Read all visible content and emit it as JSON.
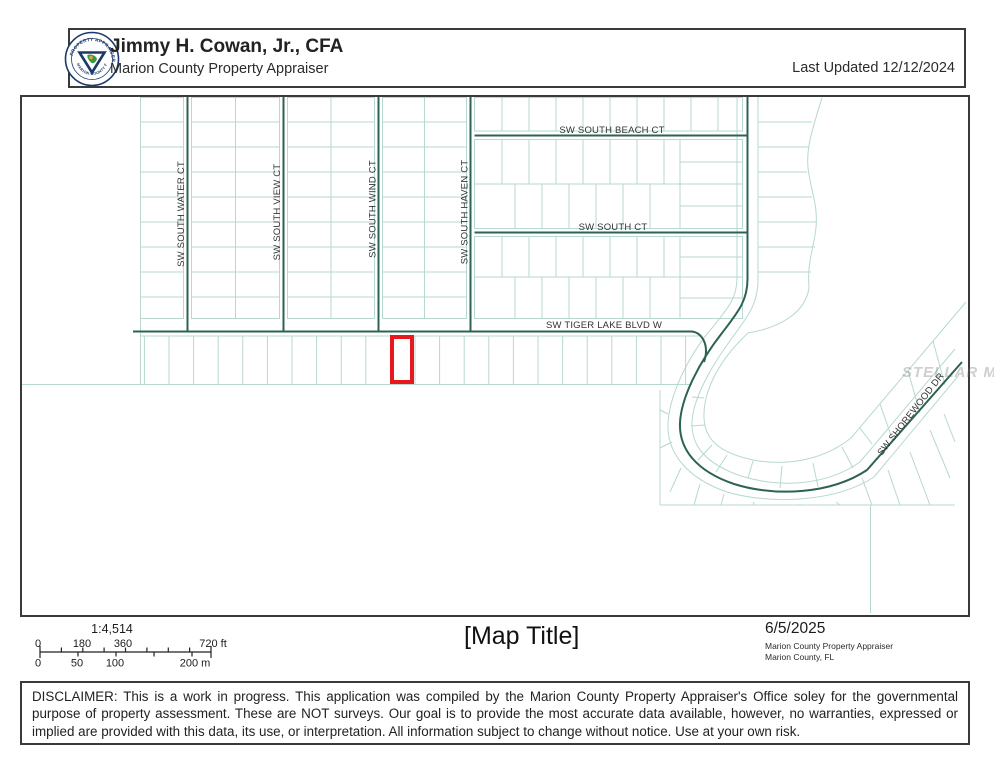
{
  "header": {
    "title": "Jimmy H. Cowan, Jr., CFA",
    "subtitle": "Marion County Property Appraiser",
    "last_updated": "Last Updated 12/12/2024",
    "logo": {
      "ring_top": "PROPERTY APPRAISER",
      "ring_bottom": "MARION COUNTY FLORIDA"
    }
  },
  "map": {
    "streets": {
      "water": "SW SOUTH WATER CT",
      "view": "SW SOUTH VIEW CT",
      "wind": "SW SOUTH WIND CT",
      "haven": "SW SOUTH HAVEN CT",
      "beach": "SW SOUTH BEACH CT",
      "south": "SW SOUTH CT",
      "tiger": "SW TIGER LAKE BLVD W",
      "shorewood": "SW SHOREWOOD DR"
    },
    "watermark": "STELLAR MLS",
    "colors": {
      "selected_parcel": "#e8191c",
      "street_line": "#2c6353",
      "parcel_line": "#b7d7d1"
    }
  },
  "footer": {
    "scale": {
      "ratio": "1:4,514",
      "ft_labels": [
        "0",
        "180",
        "360",
        "720 ft"
      ],
      "m_labels": [
        "0",
        "50",
        "100",
        "200 m"
      ]
    },
    "map_title": "[Map Title]",
    "date": "6/5/2025",
    "agency": "Marion County Property Appraiser",
    "location": "Marion County, FL"
  },
  "disclaimer": "DISCLAIMER: This is a work in progress. This application was compiled by the Marion County Property Appraiser's Office soley for the governmental purpose of property assessment. These are NOT surveys. Our goal is to provide the most accurate data available, however, no warranties, expressed or implied are provided with this data, its use, or interpretation. All information subject to change without notice. Use at your own risk."
}
